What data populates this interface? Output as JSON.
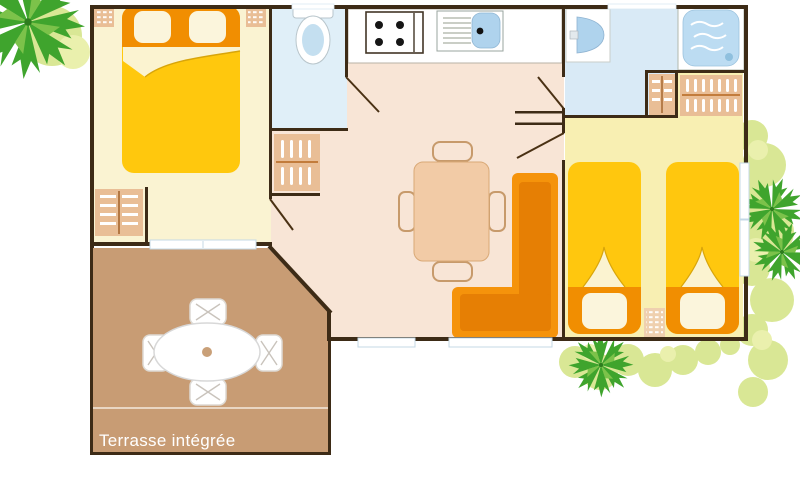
{
  "terrace": {
    "label": "Terrasse intégrée"
  },
  "palette": {
    "wall": "#3D2B16",
    "bedroom_master_floor": "#FAF3D2",
    "bedroom_twin_floor": "#F8EFB2",
    "living_floor": "#F8E5D6",
    "wc_floor": "#E0EFF8",
    "bathroom_floor": "#D9EAF6",
    "terrace_floor": "#C89C74",
    "kitchen_counter": "#FFFFFF",
    "bed_yellow": "#FFC80D",
    "bed_orange": "#F18E01",
    "pillow_cream": "#FBF5DC",
    "fold_cream": "#FBF3D0",
    "sofa_orange": "#F5930B",
    "sofa_orange_dark": "#E67F04",
    "furniture_beige": "#E9BE96",
    "furniture_beige_light": "#EFD0AF",
    "dining_beige": "#F2CBA6",
    "water_blue": "#AFD3ED",
    "shower_blue": "#BCDCF2",
    "toilet_blue": "#C4DFF0",
    "window_blue": "#C4D8E6",
    "tree_green": "#3FA42D",
    "tree_green_light": "#7CC24A",
    "bush_green": "#D9E795",
    "bush_green_pale": "#EAF0AD",
    "label_text": "#FFFFFF"
  }
}
